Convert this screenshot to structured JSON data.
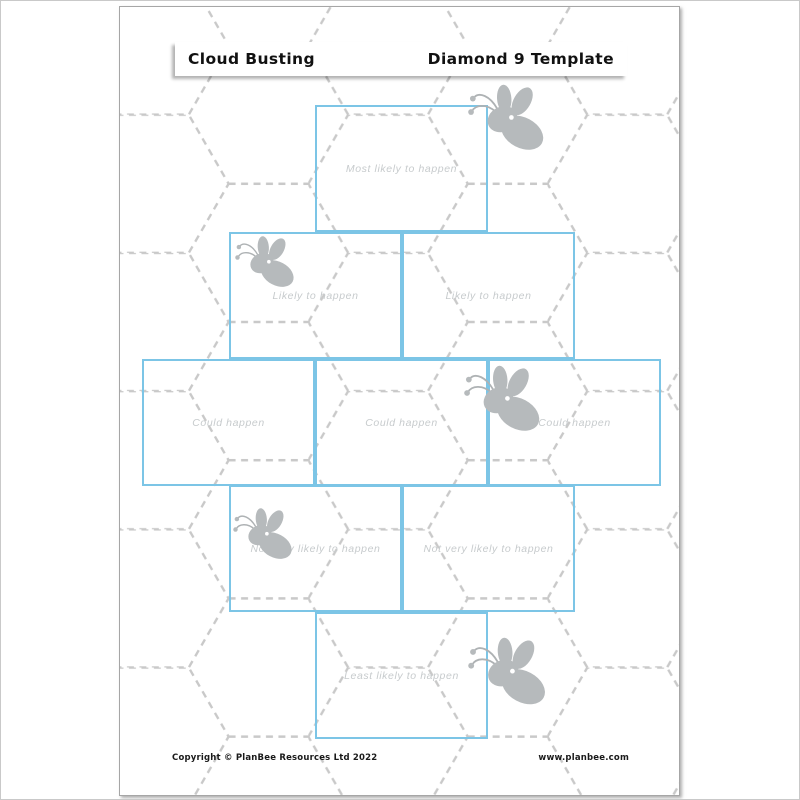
{
  "header": {
    "left_title": "Cloud Busting",
    "right_title": "Diamond 9 Template"
  },
  "diamond": {
    "boxes": [
      {
        "rank": 1,
        "label": "Most likely to happen"
      },
      {
        "rank": 2,
        "label": "Likely to happen"
      },
      {
        "rank": 3,
        "label": "Likely to happen"
      },
      {
        "rank": 4,
        "label": "Could happen"
      },
      {
        "rank": 5,
        "label": "Could happen"
      },
      {
        "rank": 6,
        "label": "Could happen"
      },
      {
        "rank": 7,
        "label": "Not very likely to happen"
      },
      {
        "rank": 8,
        "label": "Not very likely to happen"
      },
      {
        "rank": 9,
        "label": "Least likely to happen"
      }
    ]
  },
  "footer": {
    "copyright": "Copyright © PlanBee Resources Ltd 2022",
    "website": "www.planbee.com"
  },
  "icons": {
    "bee": "bee-icon",
    "background": "dashed-hexagon-pattern"
  },
  "colors": {
    "box_border": "#7cc5e6",
    "label_text": "#c7cbcd",
    "hex_pattern": "#c9c9c9",
    "bee_fill": "#b6babc",
    "header_text": "#111111"
  }
}
